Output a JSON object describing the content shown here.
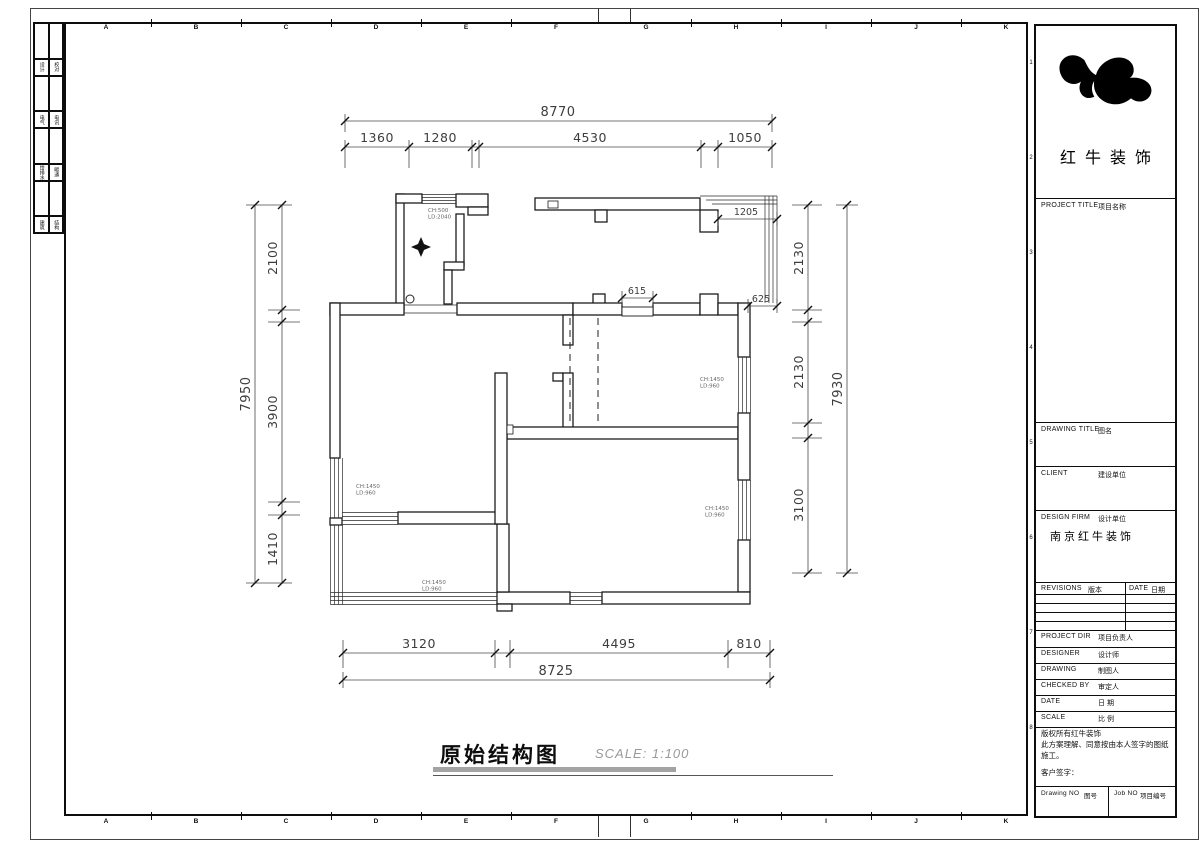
{
  "sheet": {
    "drawing_title": "原始结构图",
    "scale_note": "SCALE: 1:100"
  },
  "frame": {
    "grid_letters": [
      "A",
      "B",
      "C",
      "D",
      "E",
      "F",
      "G",
      "H",
      "I",
      "J",
      "K"
    ],
    "grid_numbers": [
      "1",
      "2",
      "3",
      "4",
      "5",
      "6",
      "7",
      "8"
    ],
    "signoff_columns": [
      {
        "left": "设计",
        "right": "校对"
      },
      {
        "left": "电气",
        "right": "电讯"
      },
      {
        "left": "给排水",
        "right": "暖通"
      },
      {
        "left": "建筑",
        "right": "结构"
      }
    ]
  },
  "title_block": {
    "brand": "红牛装饰",
    "project_title": {
      "en": "PROJECT TITLE",
      "zh": "项目名称"
    },
    "drawing_title": {
      "en": "DRAWING TITLE",
      "zh": "图名"
    },
    "client": {
      "en": "CLIENT",
      "zh": "建设单位"
    },
    "design_firm": {
      "en": "DESIGN FIRM",
      "zh": "设计单位",
      "value": "南京红牛装饰"
    },
    "revisions": {
      "en": "REVISIONS",
      "zh": "版本"
    },
    "date_col": {
      "en": "DATE",
      "zh": "日期"
    },
    "staff_rows": [
      {
        "en": "PROJECT DIR",
        "zh": "项目负责人"
      },
      {
        "en": "DESIGNER",
        "zh": "设计师"
      },
      {
        "en": "DRAWING",
        "zh": "制图人"
      },
      {
        "en": "CHECKED BY",
        "zh": "审定人"
      },
      {
        "en": "DATE",
        "zh": "日  期"
      },
      {
        "en": "SCALE",
        "zh": "比  例"
      }
    ],
    "notes": [
      "版权所有红牛装饰",
      "此方案理解、同意按由本人签字的图纸施工。",
      "客户签字："
    ],
    "drawing_no": {
      "en": "Drawing NO",
      "zh": "图号"
    },
    "job_no": {
      "en": "Job NO",
      "zh": "项目编号"
    }
  },
  "plan": {
    "dims": {
      "top_total": "8770",
      "top_segments": [
        "1360",
        "1280",
        "4530",
        "1050"
      ],
      "bottom_total": "8725",
      "bottom_segments": [
        "3120",
        "4495",
        "810"
      ],
      "left_total": "7950",
      "left_segments": [
        "2100",
        "3900",
        "1410"
      ],
      "right_total": "7930",
      "right_segments": [
        "2130",
        "2130",
        "3100"
      ],
      "detail_1205": "1205",
      "detail_615": "615",
      "detail_625": "625"
    },
    "window_labels": {
      "balcony_top": {
        "line1": "CH:500",
        "line2": "LD:2040"
      },
      "left_room": {
        "line1": "CH:1450",
        "line2": "LD:960"
      },
      "garden_room": {
        "line1": "CH:1450",
        "line2": "LD:960"
      },
      "mid_room": {
        "line1": "CH:1450",
        "line2": "LD:960"
      },
      "right_room": {
        "line1": "CH:1450",
        "line2": "LD:960"
      }
    }
  }
}
